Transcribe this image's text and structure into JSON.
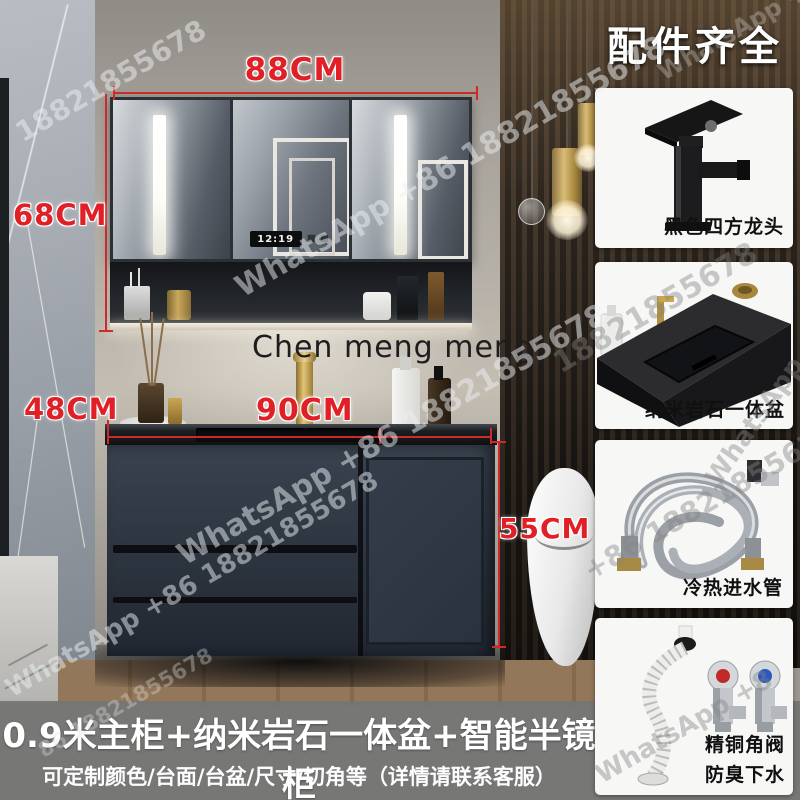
{
  "watermark": {
    "whatsapp": "WhatsApp +86 18821855678",
    "phone": "18821855678",
    "phone_short": "+86 18821855678",
    "phone_footer": "86 18821855678",
    "whatsapp_short": "WhatsApp +8",
    "brand": "Chen meng meng"
  },
  "dimensions": {
    "mirror_width": "88CM",
    "mirror_height": "68CM",
    "counter_depth": "48CM",
    "counter_width": "90CM",
    "cabinet_height": "55CM"
  },
  "scene": {
    "clock": "12:19"
  },
  "accessories": {
    "title": "配件齐全",
    "items": [
      {
        "caption": "黑色四方龙头",
        "icon": "black-square-faucet-icon"
      },
      {
        "caption": "纳米岩石一体盆",
        "icon": "nano-rock-basin-icon"
      },
      {
        "caption": "冷热进水管",
        "icon": "braided-water-hoses-icon"
      },
      {
        "caption": "精铜角阀",
        "caption2": "防臭下水",
        "icon": "angle-valves-drain-icon"
      }
    ]
  },
  "footer": {
    "title": "0.9米主柜+纳米岩石一体盆+智能半镜柜",
    "subtitle": "可定制颜色/台面/台盆/尺寸/切角等（详情请联系客服）"
  },
  "colors": {
    "dimension_red": "#e01f26",
    "card_bg": "#f7f7f6",
    "footer_overlay": "#747474",
    "cabinet_navy": "#303844",
    "accent_gold": "#c9a24a"
  }
}
